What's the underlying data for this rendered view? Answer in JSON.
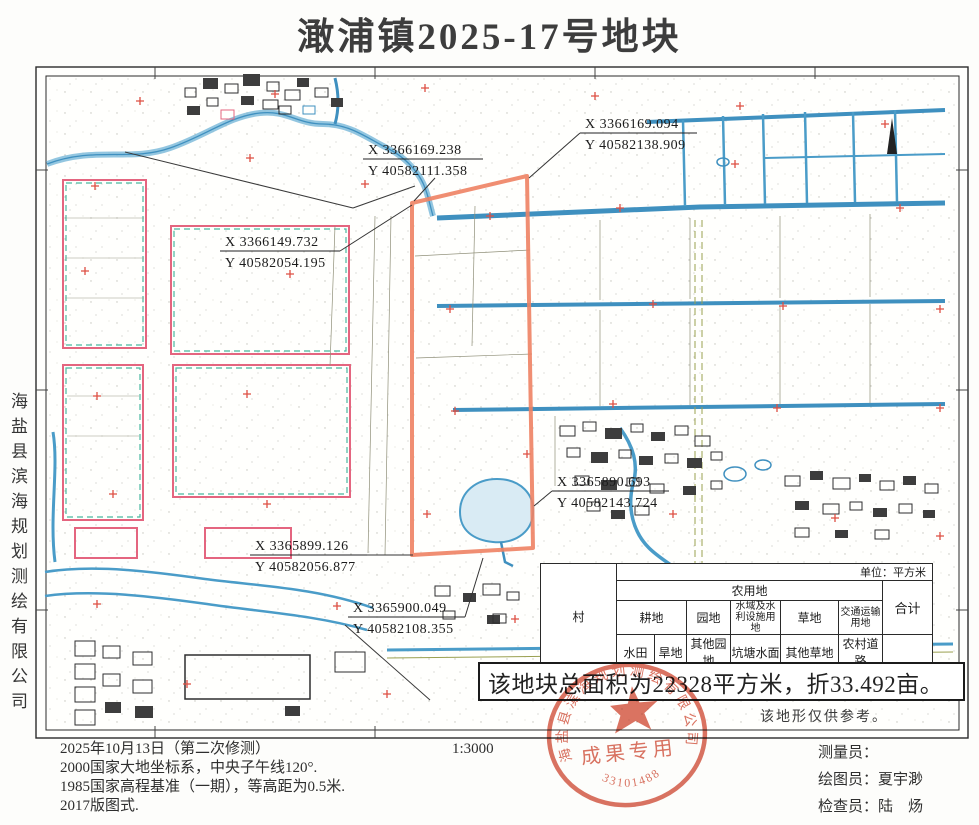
{
  "page": {
    "title": "澉浦镇2025-17号地块"
  },
  "sidebar": {
    "company": "海盐县滨海规划测绘有限公司"
  },
  "map": {
    "coords": [
      {
        "x": "X 3366149.732",
        "y": "Y 40582054.195"
      },
      {
        "x": "X 3366169.238",
        "y": "Y 40582111.358"
      },
      {
        "x": "X 3366169.094",
        "y": "Y 40582138.909"
      },
      {
        "x": "X 3365890.693",
        "y": "Y 40582143.724"
      },
      {
        "x": "X 3365899.126",
        "y": "Y 40582056.877"
      },
      {
        "x": "X 3365900.049",
        "y": "Y 40582108.355"
      }
    ],
    "reference_note": "该地形仅供参考。",
    "area_note": "该地块总面积为22328平方米，折33.492亩。",
    "parcel_color": "#ee8263"
  },
  "table": {
    "unit": "单位：平方米",
    "col_village": "村",
    "group_agricultural": "农用地",
    "col_total": "合计",
    "group_cultivated": "耕地",
    "group_garden": "园地",
    "group_water": "水域及水利设施用地",
    "group_grass": "草地",
    "group_transport": "交通运输用地",
    "sub_paddy": "水田",
    "sub_dry": "旱地",
    "sub_other_garden": "其他园地",
    "sub_pond": "坑塘水面",
    "sub_other_grass": "其他草地",
    "sub_rural_road": "农村道路",
    "row": {
      "village": "六里村",
      "paddy": "11831",
      "dry": "3444",
      "other_garden": "1612",
      "pond": "857",
      "other_grass": "3871",
      "rural_road": "713",
      "total": "22328"
    }
  },
  "stamp": {
    "ring_text": "海盐县滨海规划测绘有限公司",
    "center_text": "成果专用",
    "number": "33101488",
    "color": "#d2543f"
  },
  "footer": {
    "notes": [
      "2025年10月13日（第二次修测）",
      "2000国家大地坐标系，中央子午线120°.",
      "1985国家高程基准（一期），等高距为0.5米.",
      "2017版图式."
    ],
    "scale": "1:3000",
    "staff": [
      {
        "label": "测量员：",
        "name": ""
      },
      {
        "label": "绘图员：",
        "name": "夏宇渺"
      },
      {
        "label": "检查员：",
        "name": "陆　炀"
      }
    ]
  }
}
